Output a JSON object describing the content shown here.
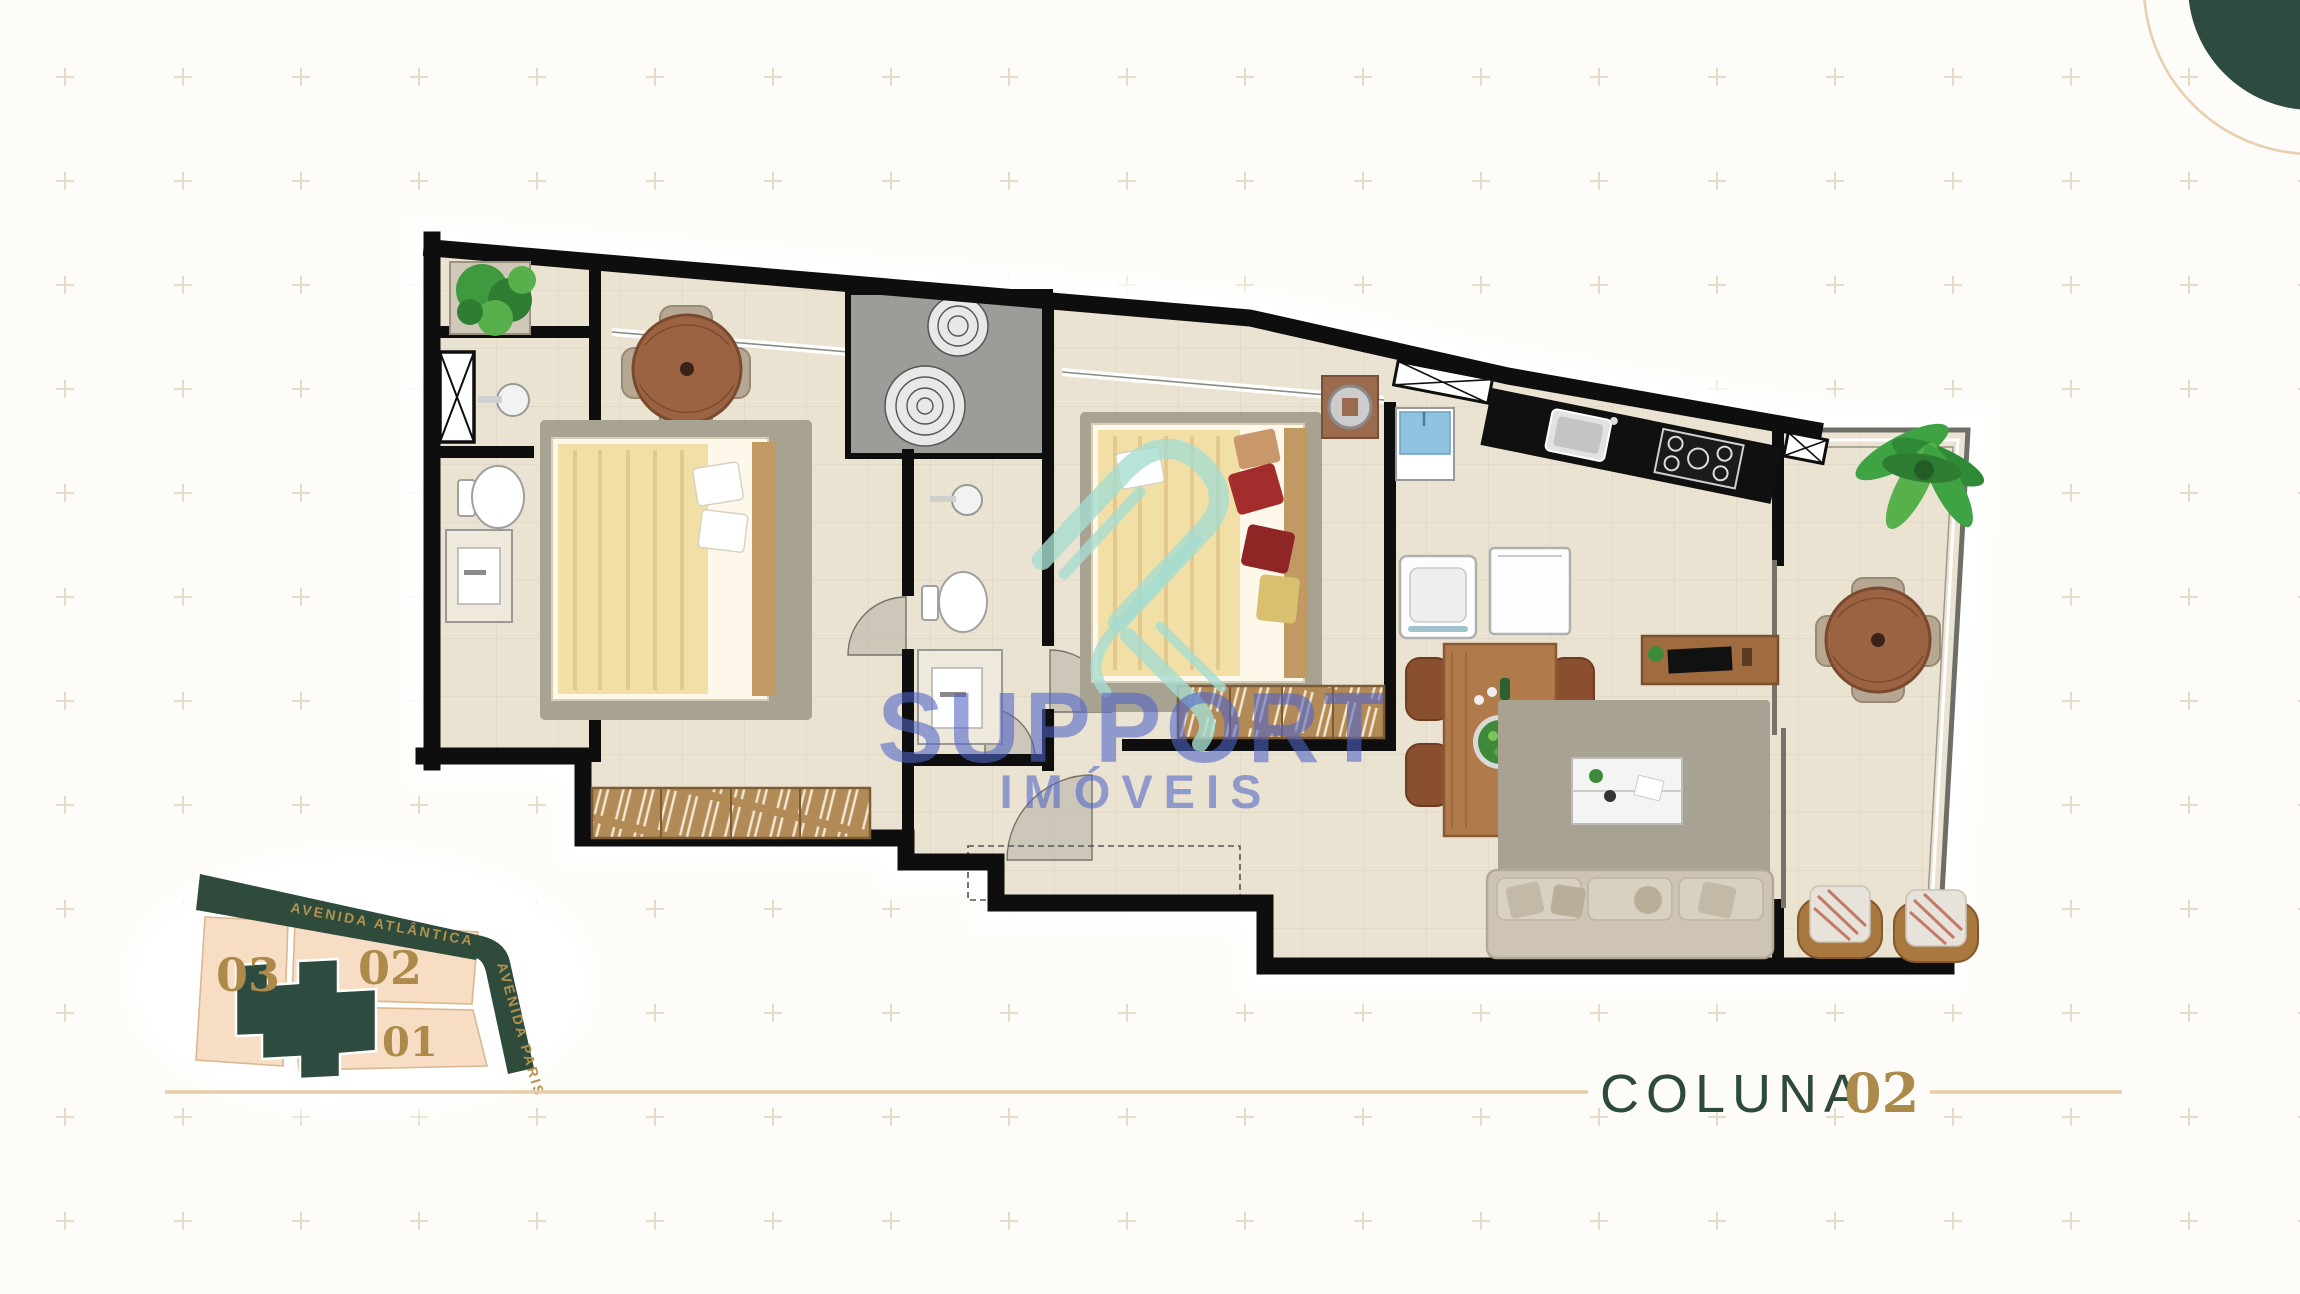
{
  "page": {
    "background_color": "#fdfcf8",
    "grid_plus_color": "#ddd2b6"
  },
  "branding": {
    "corner_circle_color": "#2e4b3f",
    "corner_arc_color": "#e8cfae"
  },
  "watermark": {
    "name": "SUPPORT",
    "subname": "IMÓVEIS",
    "text_color": "#5064c9",
    "logo_color": "#a5dccf"
  },
  "title": {
    "label": "COLUNA",
    "number": "02",
    "label_color": "#2d4a3d",
    "number_color": "#ab8a4a",
    "rule_color": "#e9cba8"
  },
  "site_map": {
    "streets": [
      {
        "label": "AVENIDA ATLÂNTICA"
      },
      {
        "label": "AVENIDA PARIS"
      }
    ],
    "lots": [
      {
        "label": "03"
      },
      {
        "label": "02"
      },
      {
        "label": "01"
      }
    ],
    "road_color": "#2e4b3c",
    "lot_color": "#f6ddc3",
    "number_color": "#ab8a4a",
    "footprint_color": "#2e4b3f"
  },
  "floor_plan": {
    "wall_color": "#0e0e0e",
    "floor_color": "#ebe3d1",
    "tile_line_color": "#ddd4c3",
    "rug_color": "#a8a292",
    "bedding_color": "#f2dfa6",
    "wood_color": "#9c6343",
    "rooms": [
      "balcony-planter",
      "bathroom-1",
      "bedroom-1",
      "stair-core",
      "bathroom-2",
      "bedroom-2",
      "kitchen-laundry",
      "living-dining",
      "terrace",
      "hall"
    ],
    "furniture": [
      "potted-plant",
      "round-dining-table",
      "double-bed",
      "wardrobe",
      "toilet",
      "pedestal-sink",
      "vanity",
      "spiral-stair",
      "kitchen-counter-sink",
      "gas-cooktop",
      "laundry-tank",
      "washing-machine",
      "dishwasher",
      "bar-table",
      "salad-bowl",
      "tv-console",
      "coffee-table",
      "sofa",
      "lounge-chair",
      "outdoor-round-table",
      "palm-plant"
    ]
  }
}
